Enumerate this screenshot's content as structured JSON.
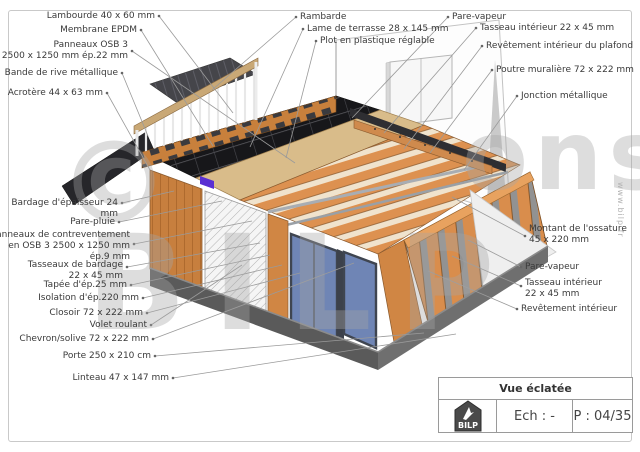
{
  "title_block": {
    "title": "Vue éclatée",
    "logo": "BILP",
    "scale": "Ech : -",
    "page": "P : 04/35"
  },
  "watermark": {
    "symbol": "©",
    "fragment_left": "BILP",
    "fragment_right": "ons"
  },
  "website_vertical": "www.bilp.fr",
  "colors": {
    "wood": "#d0853f",
    "wood_light": "#e8a25f",
    "glazing": "#6f85b5",
    "slab": "#5a5a5a",
    "membrane": "#1a1a1c",
    "logo_badge": "#4a4a4a",
    "leader_line": "#9a9a9a"
  },
  "labels": {
    "lambourde": "Lambourde 40 x 60 mm",
    "membrane": "Membrane EPDM",
    "panneaux_osb": "Panneaux OSB 3\n2500 x 1250 mm ép.22 mm",
    "bande_rive": "Bande de rive métallique",
    "acrotere": "Acrotère 44 x 63 mm",
    "rambarde": "Rambarde",
    "lame_terrasse": "Lame de terrasse 28 x 145 mm",
    "plot": "Plot en plastique réglable",
    "pare_vapeur_haut": "Pare-vapeur",
    "tasseau_interieur_haut": "Tasseau intérieur 22 x 45 mm",
    "revetement_plafond": "Revêtement intérieur du plafond",
    "poutre_muraliere": "Poutre muralière 72 x 222 mm",
    "jonction_metallique": "Jonction métallique",
    "montant_ossature": "Montant de l'ossature\n45 x 220 mm",
    "pare_vapeur_droit": "Pare-vapeur",
    "tasseau_interieur_droit": "Tasseau intérieur\n22 x 45 mm",
    "revetement_interieur": "Revêtement intérieur",
    "bardage": "Bardage d'épaisseur 24 mm",
    "pare_pluie": "Pare-pluie",
    "contreventement": "Panneaux de contreventement\nen OSB 3 2500 x 1250 mm\nép.9 mm",
    "tasseaux_bardage": "Tasseaux de bardage\n22 x 45 mm",
    "tapee": "Tapée d'ép.25 mm",
    "isolation": "Isolation d'ép.220 mm",
    "closoir": "Closoir 72 x 222 mm",
    "volet_roulant": "Volet roulant",
    "chevron_solive": "Chevron/solive 72 x 222 mm",
    "porte": "Porte 250 x 210 cm",
    "linteau": "Linteau 47 x 147 mm"
  }
}
